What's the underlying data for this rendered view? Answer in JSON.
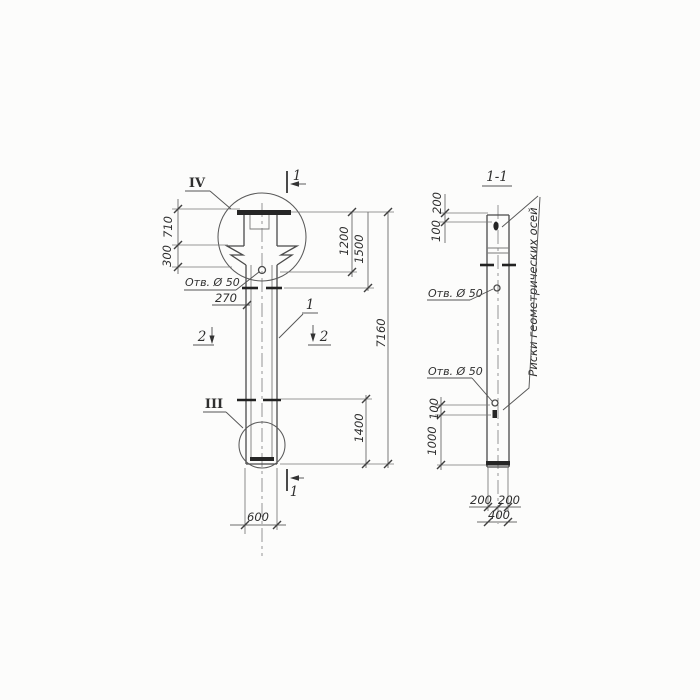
{
  "front_view": {
    "detail_top": "IV",
    "detail_bottom": "III",
    "cut_top": "1",
    "cut_bottom": "1",
    "cut2_left": "2",
    "cut2_right": "2",
    "position": "1",
    "hole_note": "Отв. Ø 50",
    "dims": {
      "d710": "710",
      "d300": "300",
      "d270": "270",
      "d1200": "1200",
      "d1500": "1500",
      "d7160": "7160",
      "d1400": "1400",
      "d600": "600"
    }
  },
  "section_view": {
    "title": "1-1",
    "hole_note_upper": "Отв. Ø 50",
    "hole_note_lower": "Отв. Ø 50",
    "axes_note": "Риски геометрических осей",
    "dims": {
      "top200": "200",
      "top100": "100",
      "mid100": "100",
      "mid1000": "1000",
      "bot200a": "200",
      "bot200b": "200",
      "bot400": "400"
    }
  }
}
